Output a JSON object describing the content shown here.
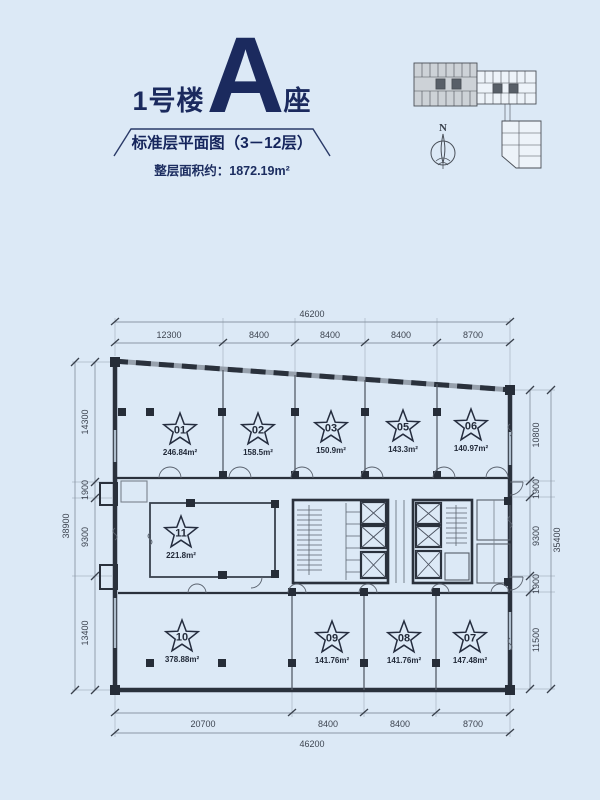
{
  "colors": {
    "background": "#dce9f6",
    "ink": "#2a313c",
    "navy": "#1b2a5e"
  },
  "header": {
    "building_prefix": "1号楼",
    "block_letter": "A",
    "block_suffix": "座",
    "plan_title": "标准层平面图（3－12层）",
    "floor_area": "整层面积约：1872.19m²"
  },
  "site_key": {
    "north_label": "N"
  },
  "plan": {
    "units": [
      {
        "id": "01",
        "area": "246.84m²"
      },
      {
        "id": "02",
        "area": "158.5m²"
      },
      {
        "id": "03",
        "area": "150.9m²"
      },
      {
        "id": "05",
        "area": "143.3m²"
      },
      {
        "id": "06",
        "area": "140.97m²"
      },
      {
        "id": "11",
        "area": "221.8m²"
      },
      {
        "id": "10",
        "area": "378.88m²"
      },
      {
        "id": "09",
        "area": "141.76m²"
      },
      {
        "id": "08",
        "area": "141.76m²"
      },
      {
        "id": "07",
        "area": "147.48m²"
      }
    ],
    "dims": {
      "top": {
        "overall": "46200",
        "segments": [
          "12300",
          "8400",
          "8400",
          "8400",
          "8700"
        ]
      },
      "bottom": {
        "overall": "46200",
        "segments": [
          "20700",
          "8400",
          "8400",
          "8700"
        ]
      },
      "left": {
        "overall": "38900",
        "segments": [
          "14300",
          "1900",
          "9300",
          "13400"
        ]
      },
      "right": {
        "overall": "35400",
        "segments": [
          "10800",
          "1900",
          "9300",
          "1900",
          "11500"
        ]
      }
    }
  }
}
